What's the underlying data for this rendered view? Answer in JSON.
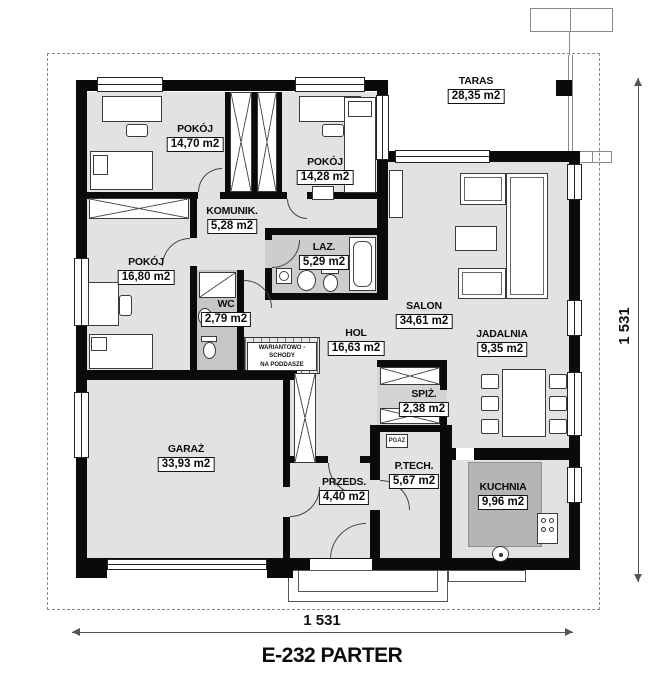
{
  "title": "E-232 PARTER",
  "dimensions": {
    "bottom": "1 531",
    "right": "1 531"
  },
  "rooms": [
    {
      "id": "taras",
      "name": "TARAS",
      "area": "28,35 m2"
    },
    {
      "id": "pokoj-1",
      "name": "POKÓJ",
      "area": "14,70 m2"
    },
    {
      "id": "pokoj-2",
      "name": "POKÓJ",
      "area": "14,28 m2"
    },
    {
      "id": "komunik",
      "name": "KOMUNIK.",
      "area": "5,28 m2"
    },
    {
      "id": "laz",
      "name": "LAZ.",
      "area": "5,29 m2"
    },
    {
      "id": "pokoj-3",
      "name": "POKÓJ",
      "area": "16,80 m2"
    },
    {
      "id": "wc",
      "name": "WC",
      "area": "2,79 m2"
    },
    {
      "id": "salon",
      "name": "SALON",
      "area": "34,61 m2"
    },
    {
      "id": "hol",
      "name": "HOL",
      "area": "16,63 m2"
    },
    {
      "id": "jadalnia",
      "name": "JADALNIA",
      "area": "9,35 m2"
    },
    {
      "id": "spiz",
      "name": "SPIŻ.",
      "area": "2,38 m2"
    },
    {
      "id": "garaz",
      "name": "GARAŻ",
      "area": "33,93 m2"
    },
    {
      "id": "przeds",
      "name": "PRZEDS.",
      "area": "4,40 m2"
    },
    {
      "id": "ptech",
      "name": "P.TECH.",
      "area": "5,67 m2"
    },
    {
      "id": "kuchnia",
      "name": "KUCHNIA",
      "area": "9,96 m2"
    }
  ],
  "annotations": {
    "stairs_note_line1": "WARIANTOWO - SCHODY",
    "stairs_note_line2": "NA PODDASZE",
    "gas_label": "PGAZ"
  },
  "colors": {
    "wall": "#0a0a0a",
    "floor": "#e2e2e2",
    "wet_floor": "#cdcdcd",
    "kitchen_counter": "#b5b5b5",
    "boundary_dash": "#8a8a8a"
  }
}
